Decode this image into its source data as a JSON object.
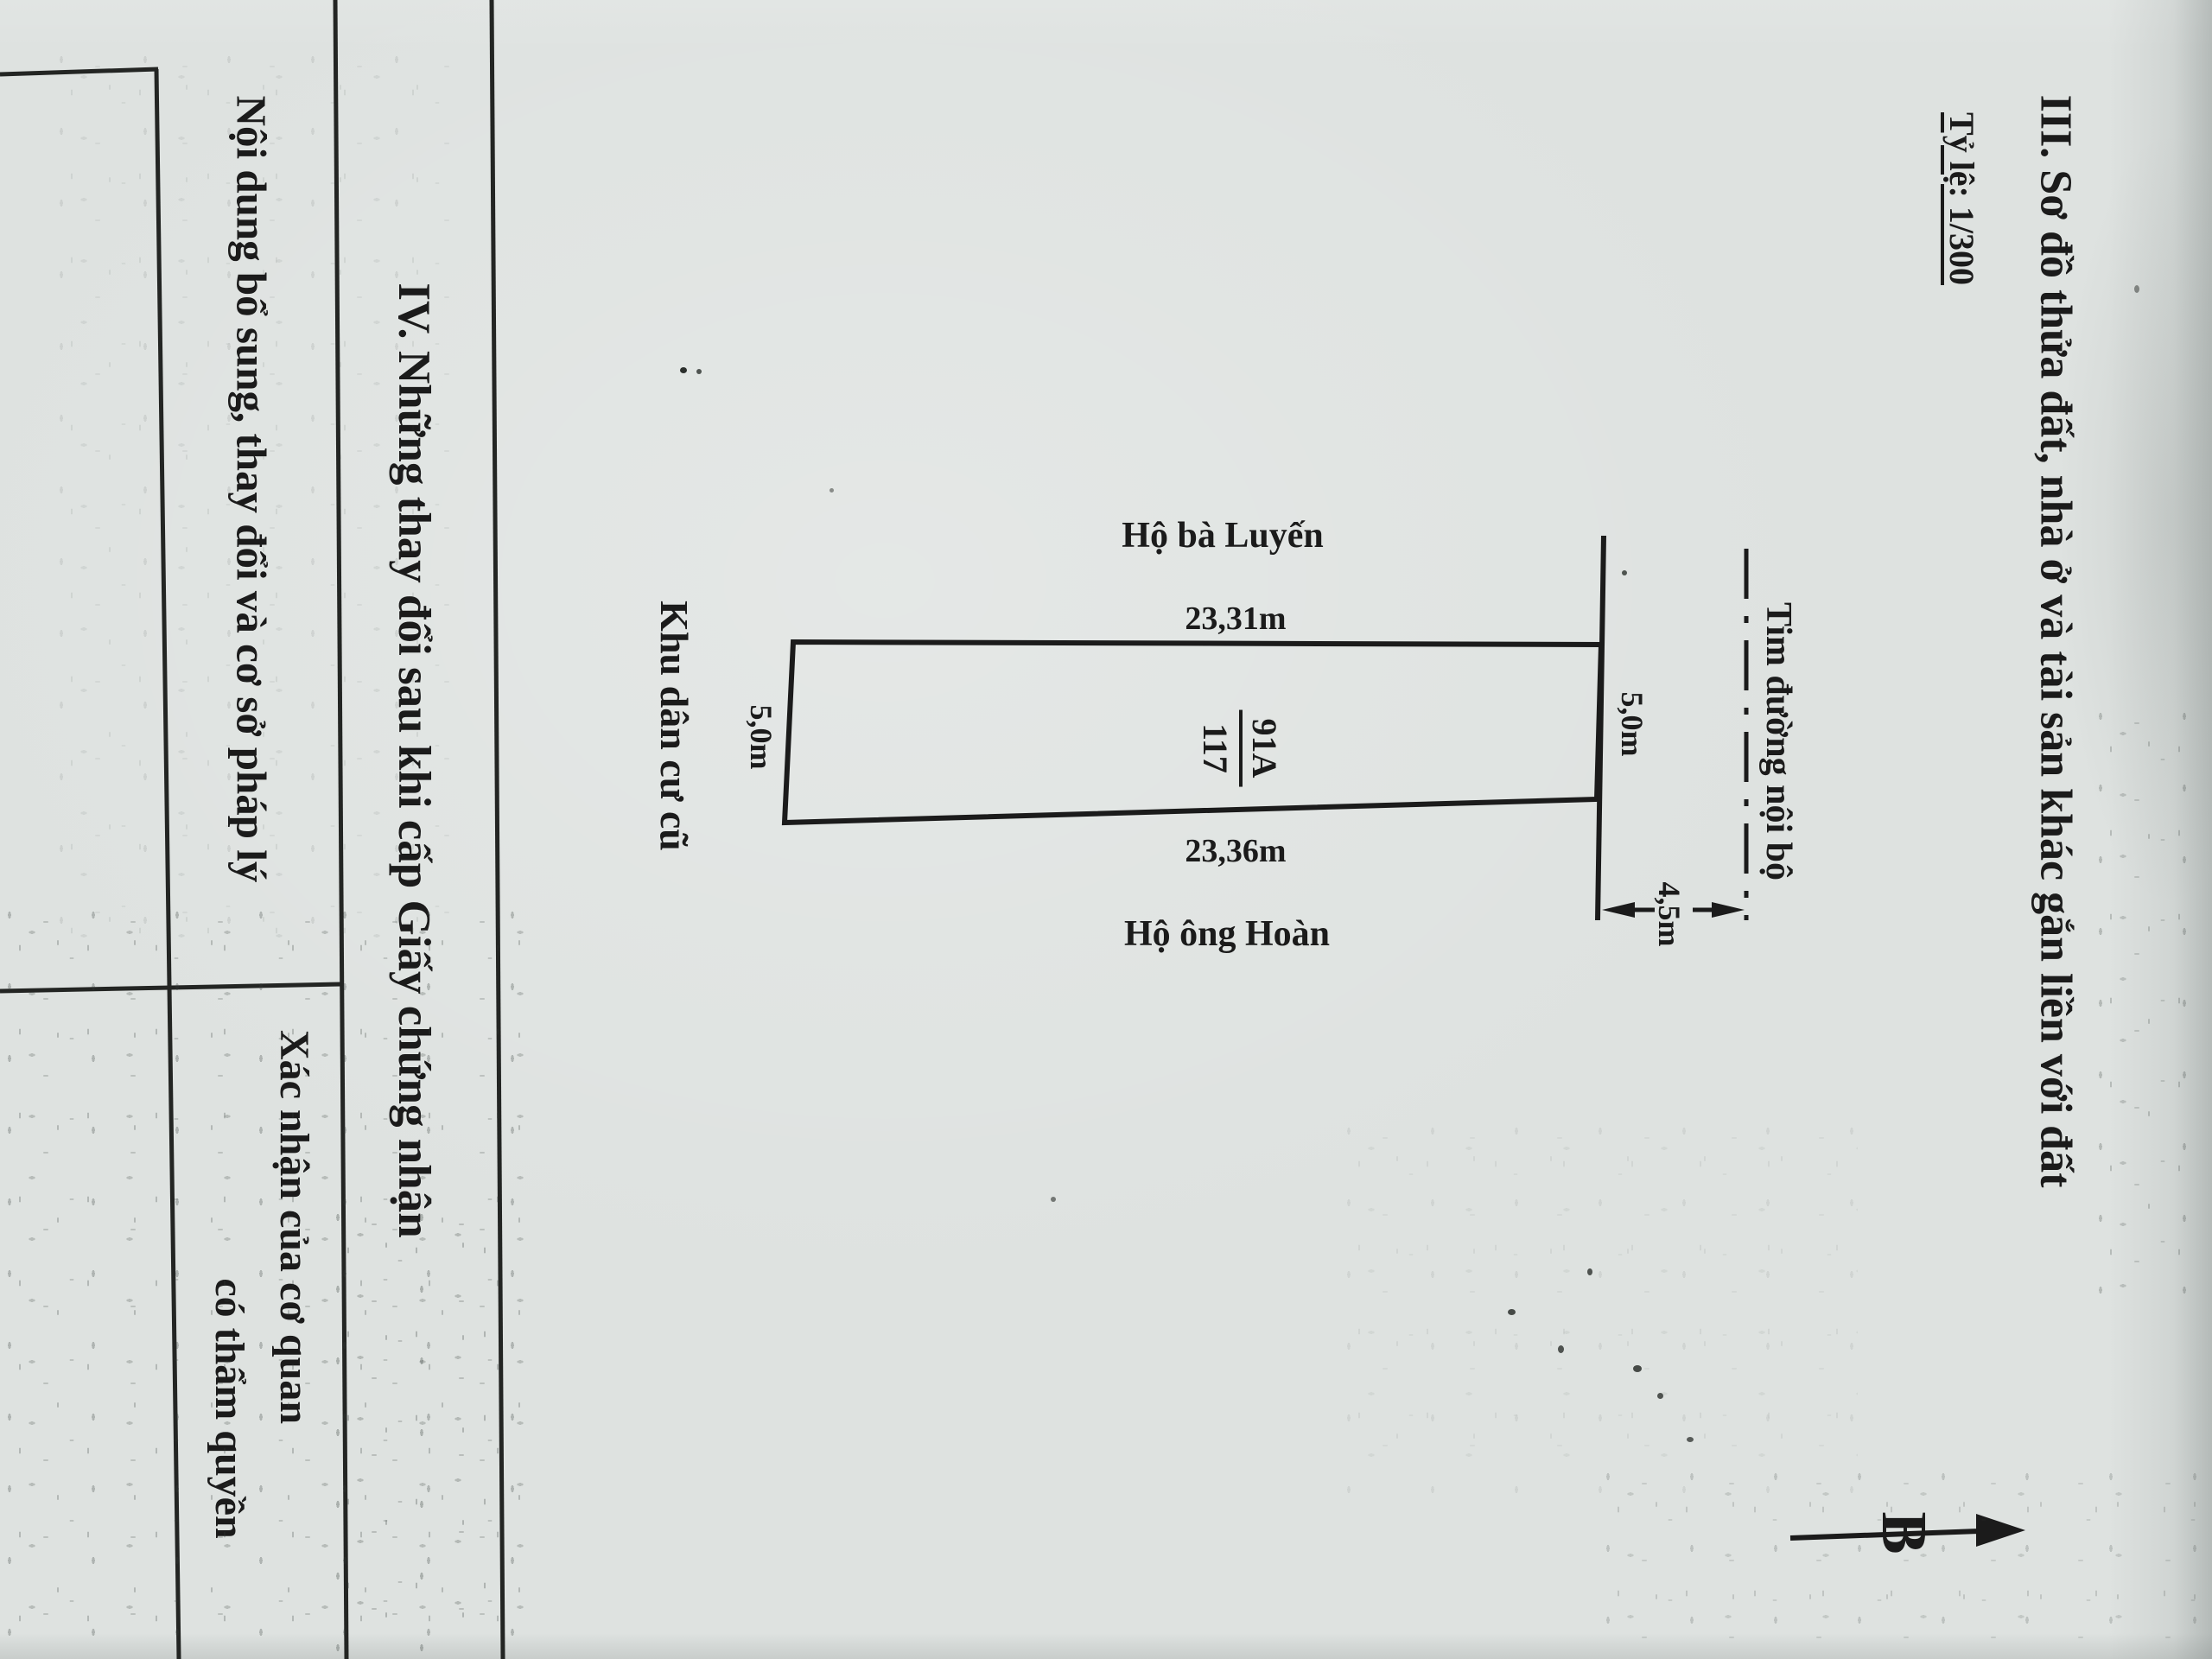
{
  "colors": {
    "paper": "#dee2e0",
    "ink": "#1b1b1b"
  },
  "section_iii": {
    "heading": "III. Sơ đồ thửa đất, nhà ở và tài sản khác gắn liền với đất",
    "scale": "Tỷ lệ: 1/300"
  },
  "diagram": {
    "parcel_number": "91A",
    "parcel_denominator": "117",
    "top_length": "23,31m",
    "bottom_length": "23,36m",
    "left_width": "5,0m",
    "right_width": "5,0m",
    "road_offset": "4,5m",
    "neighbor_top": "Hộ bà Luyến",
    "neighbor_bottom": "Hộ ông Hoàn",
    "left_area": "Khu dân cư cũ",
    "road_centerline": "Tim đường nội bộ",
    "north": "B"
  },
  "section_iv": {
    "heading": "IV. Những thay đổi sau khi cấp Giấy chứng nhận",
    "column_left": "Nội dung bổ sung, thay đổi và cơ sở pháp lý",
    "column_right_line1": "Xác nhận của cơ quan",
    "column_right_line2": "có thẩm quyền"
  }
}
